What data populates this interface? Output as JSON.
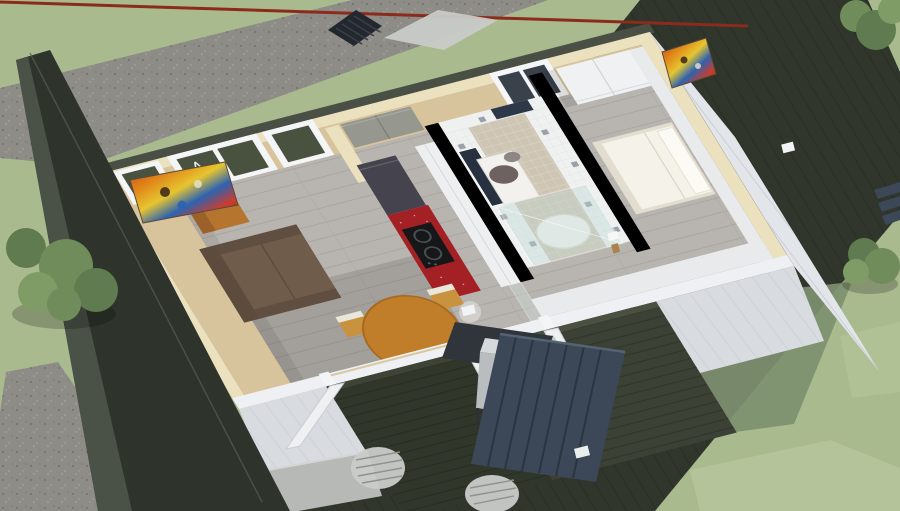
{
  "scene": {
    "description": "Aerial dollhouse 3D render of a one-storey home interior with cut-away walls, surrounded by lawn, gravel path, dark neighbouring structures and a rear timber deck",
    "view": "bird's-eye perspective, house rotated diagonally",
    "rooms": [
      {
        "name": "living-room",
        "furniture": [
          "brown sofa",
          "caramel armchair",
          "round amber dining table",
          "four wooden chairs",
          "abstract painting"
        ]
      },
      {
        "name": "kitchen",
        "furniture": [
          "charcoal fridge",
          "red sparkle counter",
          "black cooktop",
          "white tall cabinets",
          "glass partition"
        ]
      },
      {
        "name": "bathroom",
        "furniture": [
          "pedestal washbasin",
          "navy mirror",
          "glass shower enclosure",
          "round white tub",
          "white tiles with grey accents"
        ]
      },
      {
        "name": "hall",
        "furniture": [
          "grey closet doors"
        ]
      },
      {
        "name": "bedroom",
        "furniture": [
          "white double bed",
          "white wardrobe",
          "abstract painting",
          "towel ring"
        ]
      }
    ],
    "exterior": [
      "sage lawn",
      "gravel path",
      "dark boundary wall",
      "dark neighbour roof",
      "rear deck",
      "outdoor grill station",
      "slatted privacy screen",
      "outdoor table",
      "two wire chairs",
      "heat-pump unit",
      "bushes",
      "wall lamps",
      "red roof fascia"
    ]
  },
  "palette": {
    "lawn": "#a9ba8e",
    "lawn_light": "#b9c89e",
    "lawn_shadow": "#7e9070",
    "gravel": "#8d8c87",
    "gravel_dot": "#77766f",
    "dark_structure": "#2e342b",
    "dark_structure_light": "#4a5146",
    "roof_dark": "#30362c",
    "wall_tan": "#d8c49c",
    "wall_cream": "#ece1bf",
    "wall_outer_dark": "#4a4f45",
    "wall_white": "#eef0f3",
    "inner_white": "#e8eaec",
    "tile": "#eff1f1",
    "tile_accent": "#9aa2a8",
    "bath_floor": "#cfc5b3",
    "floor": "#b8b4af",
    "siding": "#e2e5e9",
    "siding_front": "#d8dce0",
    "glass_dark": "#49523f",
    "glass_blue": "#39414b",
    "window_frame": "#f4f5f6",
    "fridge": "#45444e",
    "counter_red": "#a32025",
    "cooktop": "#151718",
    "cabinet_white": "#edeff1",
    "closet_gray": "#96978f",
    "sofa": "#6f5c4b",
    "sofa_dark": "#5d4c3e",
    "armchair": "#b5752f",
    "armchair_dark": "#9c6128",
    "table_wood": "#c07d2a",
    "chair_wood": "#c8923f",
    "chair_back": "#e9e6dc",
    "bed_white": "#f5f2ea",
    "bed_base": "#e3ddd0",
    "wardrobe": "#eff1f2",
    "deck": "#3b4134",
    "deck_light": "#4a5140",
    "screen_blue": "#3c4857",
    "screen_gap": "#2b3542",
    "grill_steel": "#b9bdc0",
    "grill_top": "#d6d9db",
    "grill_counter": "#2f353a",
    "outdoor_white": "#dfe1e0",
    "outdoor_table": "#b6b9b6",
    "wire_chair": "#c9ccc9",
    "mirror_navy": "#27313f",
    "door_navy": "#2d3848",
    "fascia_red": "#8a2b1b",
    "shadow": "rgba(0,0,0,0.20)",
    "bush_dark": "#5f7b4f",
    "bush_mid": "#6f8c5a",
    "bush_light": "#7f9c66",
    "art_red": "#c23a1e",
    "art_orange": "#e08418",
    "art_yellow": "#e6c530",
    "art_blue": "#2e63b0",
    "art_dark": "#3a2a18"
  }
}
